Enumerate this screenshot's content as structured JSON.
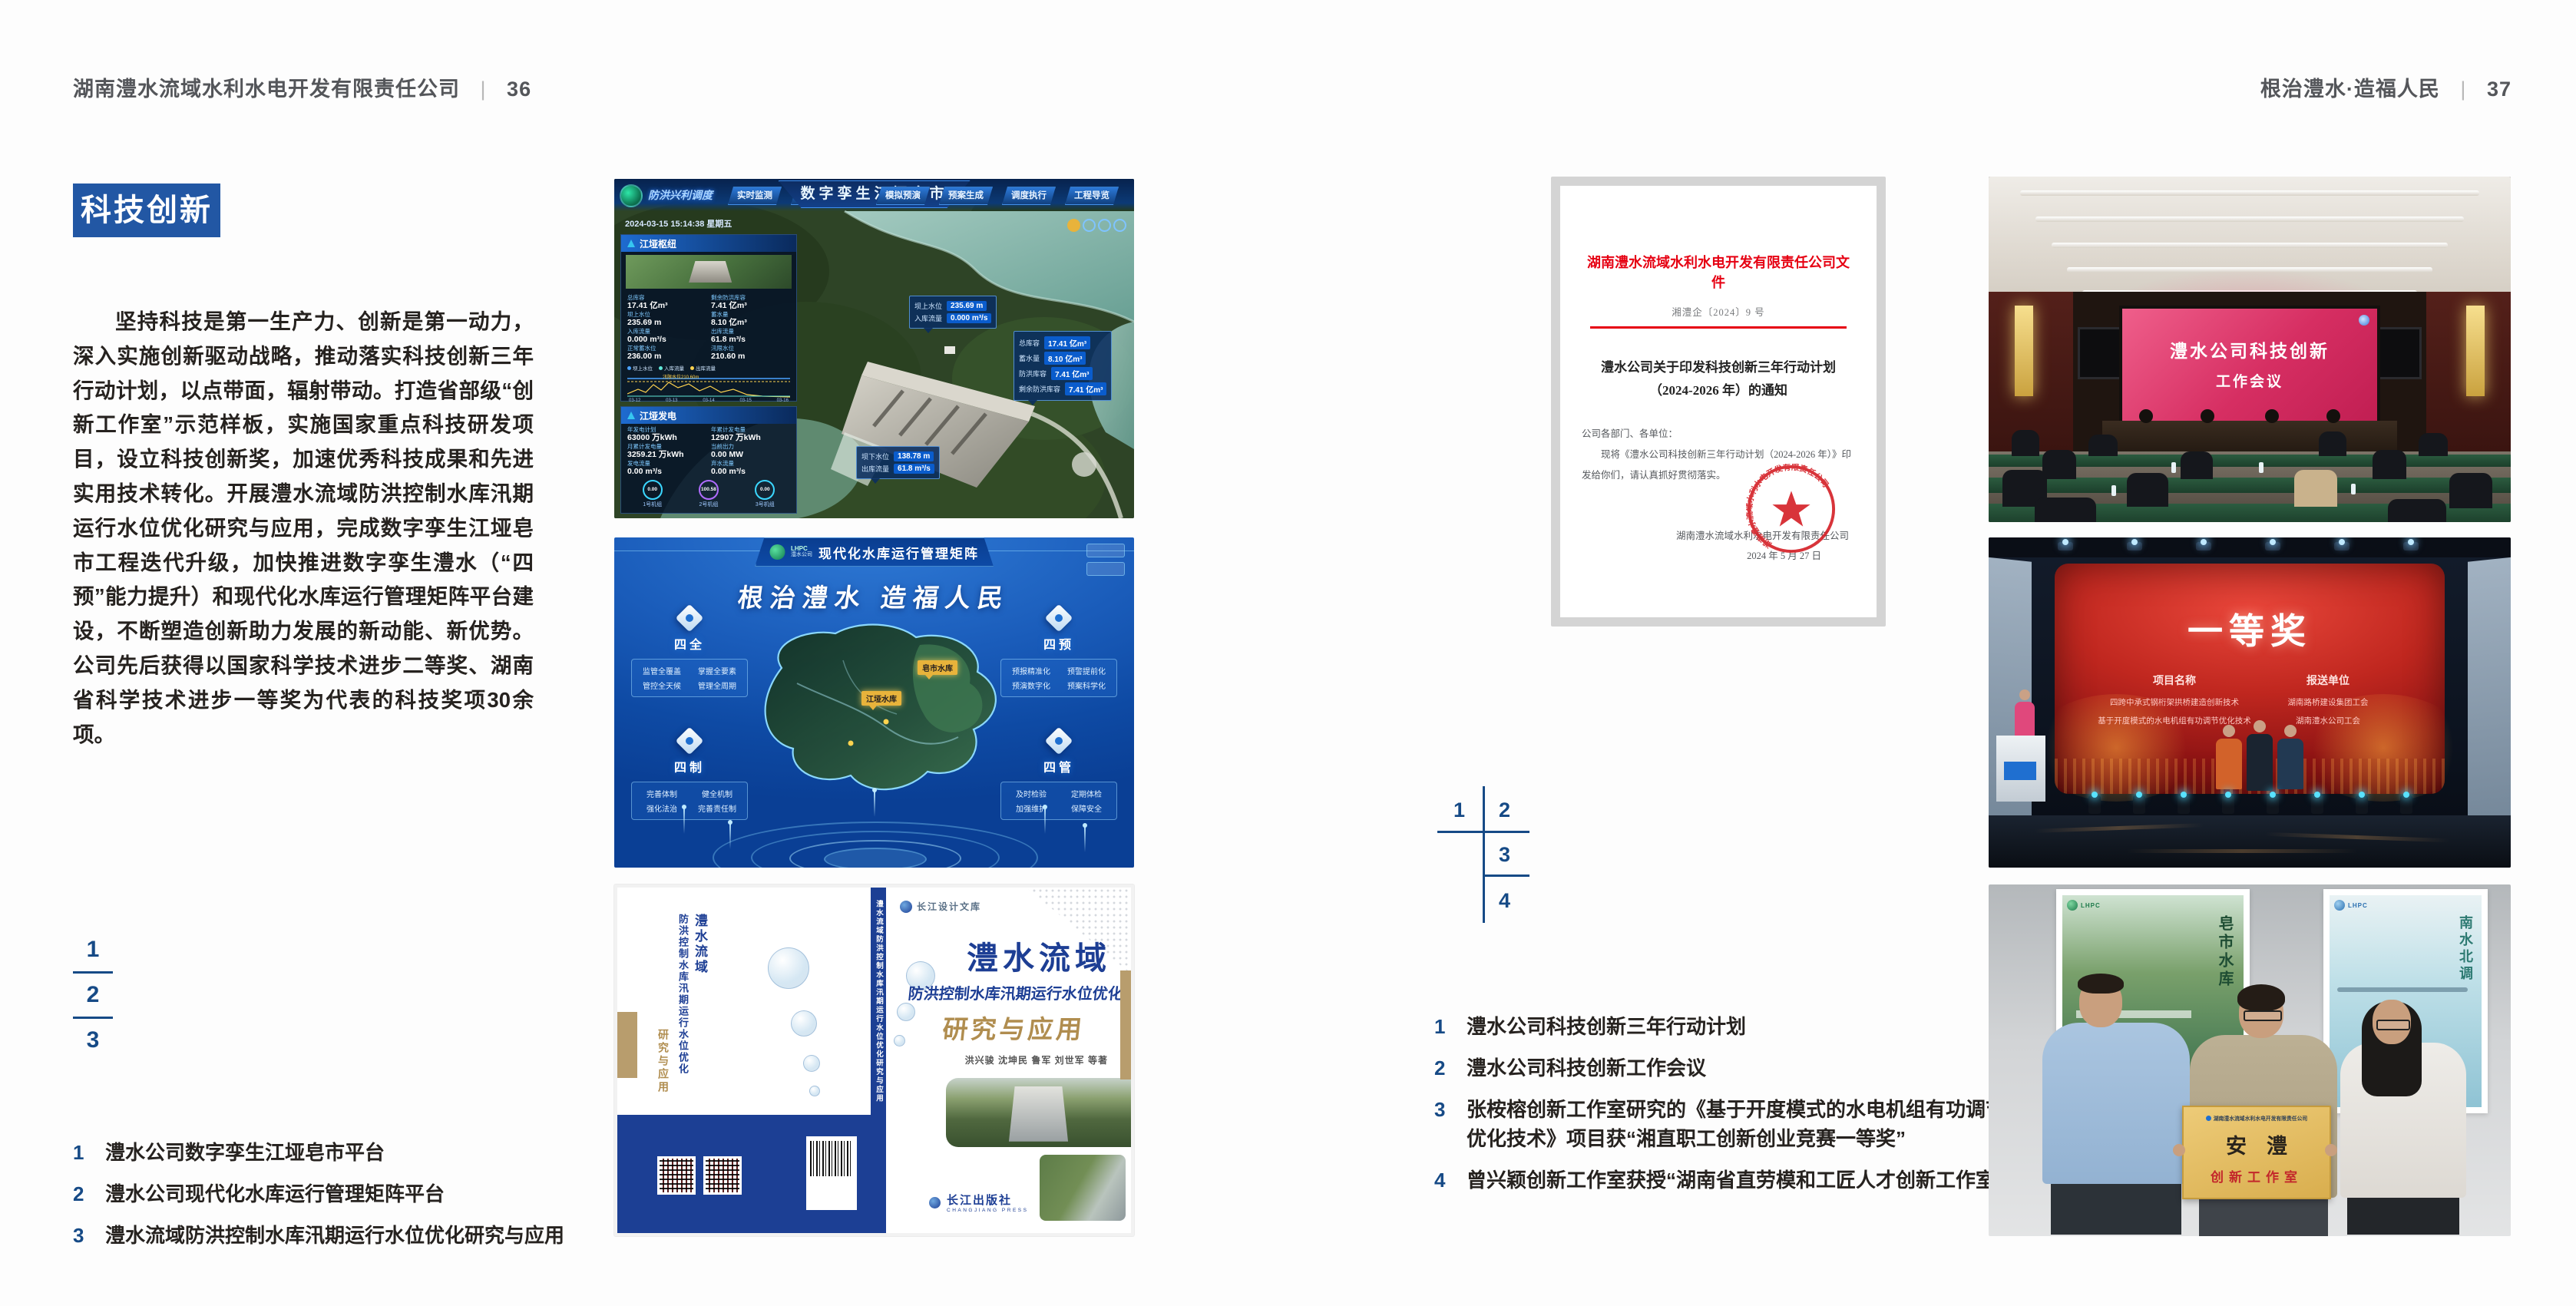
{
  "header_left": {
    "title": "湖南澧水流域水利水电开发有限责任公司",
    "separator": "|",
    "page": "36"
  },
  "header_right": {
    "title": "根治澧水·造福人民",
    "separator": "|",
    "page": "37"
  },
  "left_page": {
    "section_title": "科技创新",
    "paragraph": "坚持科技是第一生产力、创新是第一动力，深入实施创新驱动战略，推动落实科技创新三年行动计划，以点带面，辐射带动。打造省部级“创新工作室”示范样板，实施国家重点科技研发项目，设立科技创新奖，加速优秀科技成果和先进实用技术转化。开展澧水流域防洪控制水库汛期运行水位优化研究与应用，完成数字孪生江垭皂市工程迭代升级，加快推进数字孪生澧水（“四预”能力提升）和现代化水库运行管理矩阵平台建设，不断塑造创新助力发展的新动能、新优势。公司先后获得以国家科学技术进步二等奖、湖南省科学技术进步一等奖为代表的科技奖项30余项。",
    "figure_index": [
      "1",
      "2",
      "3"
    ],
    "captions": [
      {
        "num": "1",
        "text": "澧水公司数字孪生江垭皂市平台"
      },
      {
        "num": "2",
        "text": "澧水公司现代化水库运行管理矩阵平台"
      },
      {
        "num": "3",
        "text": "澧水流域防洪控制水库汛期运行水位优化研究与应用"
      }
    ]
  },
  "right_page": {
    "figure_index": [
      "1",
      "2",
      "3",
      "4"
    ],
    "captions": [
      {
        "num": "1",
        "text": "澧水公司科技创新三年行动计划"
      },
      {
        "num": "2",
        "text": "澧水公司科技创新工作会议"
      },
      {
        "num": "3",
        "text": "张桉榕创新工作室研究的《基于开度模式的水电机组有功调节优化技术》项目获“湘直职工创新创业竞赛一等奖”"
      },
      {
        "num": "4",
        "text": "曾兴颖创新工作室获授“湖南省直劳模和工匠人才创新工作室”"
      }
    ]
  },
  "fig_dashboard": {
    "title": "数字孪生江垭皂市",
    "mode_label": "防洪兴利调度",
    "tabs_left": [
      "实时监测",
      "洪水预报",
      "防洪预警"
    ],
    "tabs_right": [
      "模拟预演",
      "预案生成",
      "调度执行",
      "工程导览"
    ],
    "timestamp": "2024-03-15 15:14:38 星期五",
    "panel1": {
      "title": "江垭枢纽",
      "stats": [
        {
          "label": "总库容",
          "value": "17.41 亿m³"
        },
        {
          "label": "剩余防洪库容",
          "value": "7.41 亿m³"
        },
        {
          "label": "坝上水位",
          "value": "235.69 m"
        },
        {
          "label": "蓄水量",
          "value": "8.10 亿m³"
        },
        {
          "label": "入库流量",
          "value": "0.000 m³/s"
        },
        {
          "label": "出库流量",
          "value": "61.8 m³/s"
        },
        {
          "label": "正常蓄水位",
          "value": "236.00 m"
        },
        {
          "label": "汛限水位",
          "value": "210.60 m"
        }
      ],
      "chart_legend": [
        "坝上水位",
        "入库流量",
        "出库流量"
      ],
      "chart_x": [
        "03-12",
        "03-13",
        "03-14",
        "03-15",
        "03-16"
      ],
      "chart_note": "汛限水位210.60m"
    },
    "panel2": {
      "title": "江垭发电",
      "stats": [
        {
          "label": "年发电计划",
          "value": "63000 万kWh"
        },
        {
          "label": "年累计发电量",
          "value": "12907 万kWh"
        },
        {
          "label": "月累计发电量",
          "value": "3259.21 万kWh"
        },
        {
          "label": "当前出力",
          "value": "0.00 MW"
        },
        {
          "label": "发电流量",
          "value": "0.00 m³/s"
        },
        {
          "label": "弃水流量",
          "value": "0.00 m³/s"
        }
      ],
      "unit_values": [
        "0.00",
        "100.58",
        "0.00"
      ],
      "units": [
        "1号机组",
        "2号机组",
        "3号机组"
      ]
    },
    "callout1": {
      "rows": [
        {
          "label": "坝上水位",
          "value": "235.69 m"
        },
        {
          "label": "入库流量",
          "value": "0.000 m³/s"
        }
      ]
    },
    "callout2": {
      "rows": [
        {
          "label": "总库容",
          "value": "17.41 亿m³"
        },
        {
          "label": "蓄水量",
          "value": "8.10 亿m³"
        },
        {
          "label": "防洪库容",
          "value": "7.41 亿m³"
        },
        {
          "label": "剩余防洪库容",
          "value": "7.41 亿m³"
        }
      ]
    },
    "callout3": {
      "rows": [
        {
          "label": "坝下水位",
          "value": "138.78 m"
        },
        {
          "label": "出库流量",
          "value": "61.8 m³/s"
        }
      ]
    }
  },
  "fig_matrix": {
    "logo_top": "LHPC",
    "logo_sub": "澧水公司",
    "title": "现代化水库运行管理矩阵",
    "slogan": "根治澧水  造福人民",
    "groups": [
      {
        "label": "四全",
        "items": [
          "监管全覆盖",
          "掌握全要素",
          "管控全天候",
          "管理全周期"
        ]
      },
      {
        "label": "四预",
        "items": [
          "预报精准化",
          "预警提前化",
          "预演数字化",
          "预案科学化"
        ]
      },
      {
        "label": "四制",
        "items": [
          "完善体制",
          "健全机制",
          "强化法治",
          "完善责任制"
        ]
      },
      {
        "label": "四管",
        "items": [
          "及时检验",
          "定期体检",
          "加强维护",
          "保障安全"
        ]
      }
    ],
    "map_tags": [
      "皂市水库",
      "江垭水库"
    ]
  },
  "fig_book": {
    "series": "长江设计文库",
    "title_line1": "澧水流域",
    "title_line2": "防洪控制水库汛期运行水位优化",
    "title_line3": "研究与应用",
    "authors": "洪兴骏  沈坤民  鲁军  刘世军  等著",
    "publisher": "长江出版社",
    "publisher_en": "CHANGJIANG PRESS",
    "spine_text": "澧水流域防洪控制水库汛期运行水位优化研究与应用",
    "back_title_1": "澧水流域",
    "back_title_2": "防洪控制水库汛期运行水位优化",
    "back_title_3": "研究与应用"
  },
  "fig_document": {
    "header": "湖南澧水流域水利水电开发有限责任公司文件",
    "doc_no": "湘澧企〔2024〕9 号",
    "title": "澧水公司关于印发科技创新三年行动计划（2024-2026 年）的通知",
    "salutation": "公司各部门、各单位：",
    "body": "现将《澧水公司科技创新三年行动计划（2024-2026 年）》印发给你们，请认真抓好贯彻落实。",
    "signer": "湖南澧水流域水利水电开发有限责任公司",
    "date": "2024 年 5 月 27 日"
  },
  "fig_meeting": {
    "screen_line1": "澧水公司科技创新",
    "screen_line2": "工作会议"
  },
  "fig_award": {
    "headline": "一等奖",
    "col1_header": "项目名称",
    "col1_items": [
      "四跨中承式钢桁架拱桥建造创新技术",
      "基于开度模式的水电机组有功调节优化技术"
    ],
    "col2_header": "报送单位",
    "col2_items": [
      "湖南路桥建设集团工会",
      "湖南澧水公司工会"
    ]
  },
  "fig_group": {
    "plaque_org": "湖南澧水流域水利水电开发有限责任公司",
    "plaque_title": "安澧",
    "plaque_subtitle": "创新工作室",
    "poster_logo": "LHPC",
    "poster_left_text": "皂市水库",
    "poster_right_text": "南水北调"
  }
}
